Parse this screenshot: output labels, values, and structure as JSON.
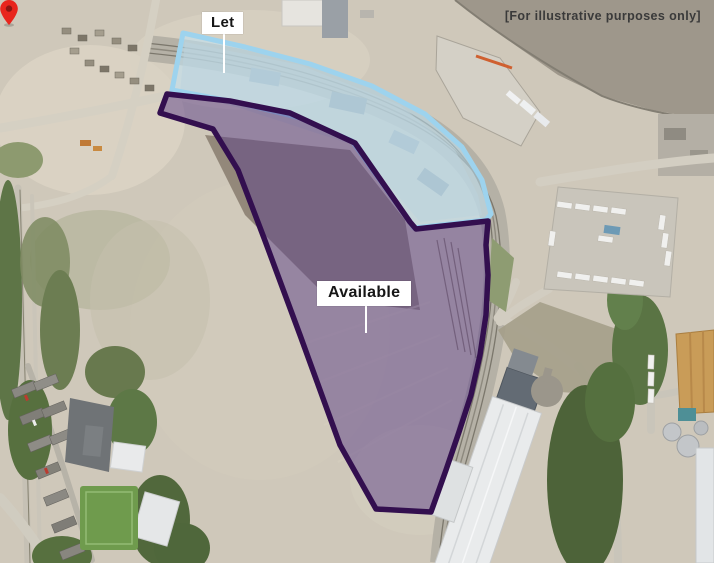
{
  "map": {
    "disclaimer": "[For illustrative purposes only]",
    "areas": {
      "let": {
        "label": "Let",
        "fill": "#bfe4f6",
        "stroke": "#9dd3ee"
      },
      "available": {
        "label": "Available",
        "fill": "#5b4087",
        "stroke": "#330f4f"
      }
    },
    "marker": {
      "color": "#e8251d",
      "dot_color": "#8c1713"
    }
  }
}
